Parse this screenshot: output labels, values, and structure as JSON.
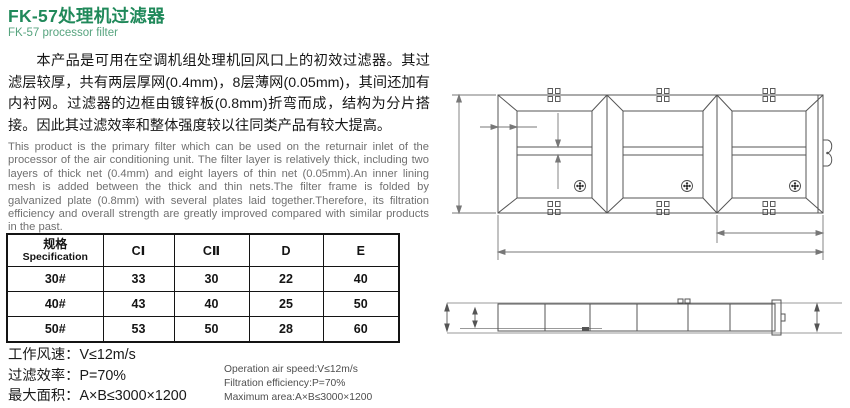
{
  "header": {
    "title": "FK-57处理机过滤器",
    "subtitle": "FK-57 processor filter"
  },
  "description_cn": "本产品是可用在空调机组处理机回风口上的初效过滤器。其过滤层较厚，共有两层厚网(0.4mm)，8层薄网(0.05mm)，其间还加有内衬网。过滤器的边框由镀锌板(0.8mm)折弯而成，结构为分片搭接。因此其过滤效率和整体强度较以往同类产品有较大提高。",
  "description_en": "This product is the primary filter which can be used on the returnair inlet of the processor of the air conditioning unit. The filter layer is relatively thick, including two layers of thick net (0.4mm) and eight layers of thin net (0.05mm).An inner lining mesh is added between the thick and thin nets.The filter frame is folded by galvanized plate (0.8mm) with several plates laid together.Therefore, its filtration efficiency and overall strength are greatly improved compared with similar products in the past.",
  "spec_table": {
    "headers": {
      "specification_cn": "规格",
      "specification_en": "Specification",
      "c1": "CⅠ",
      "c2": "CⅡ",
      "d": "D",
      "e": "E"
    },
    "rows": [
      {
        "spec": "30#",
        "c1": "33",
        "c2": "30",
        "d": "22",
        "e": "40"
      },
      {
        "spec": "40#",
        "c1": "43",
        "c2": "40",
        "d": "25",
        "e": "50"
      },
      {
        "spec": "50#",
        "c1": "53",
        "c2": "50",
        "d": "28",
        "e": "60"
      }
    ]
  },
  "operating_specs_cn": [
    "工作风速：V≤12m/s",
    "过滤效率：P=70%",
    "最大面积：A×B≤3000×1200"
  ],
  "operating_specs_en": [
    "Operation air speed:V≤12m/s",
    "Filtration efficiency:P=70%",
    "Maximum area:A×B≤3000×1200"
  ],
  "colors": {
    "title_green": "#20895a",
    "subtitle_green": "#57a47f",
    "body_text": "#151515",
    "secondary_text": "#707070",
    "table_border": "#141414",
    "drawing_line": "#555555",
    "dimension_line": "#777777"
  }
}
